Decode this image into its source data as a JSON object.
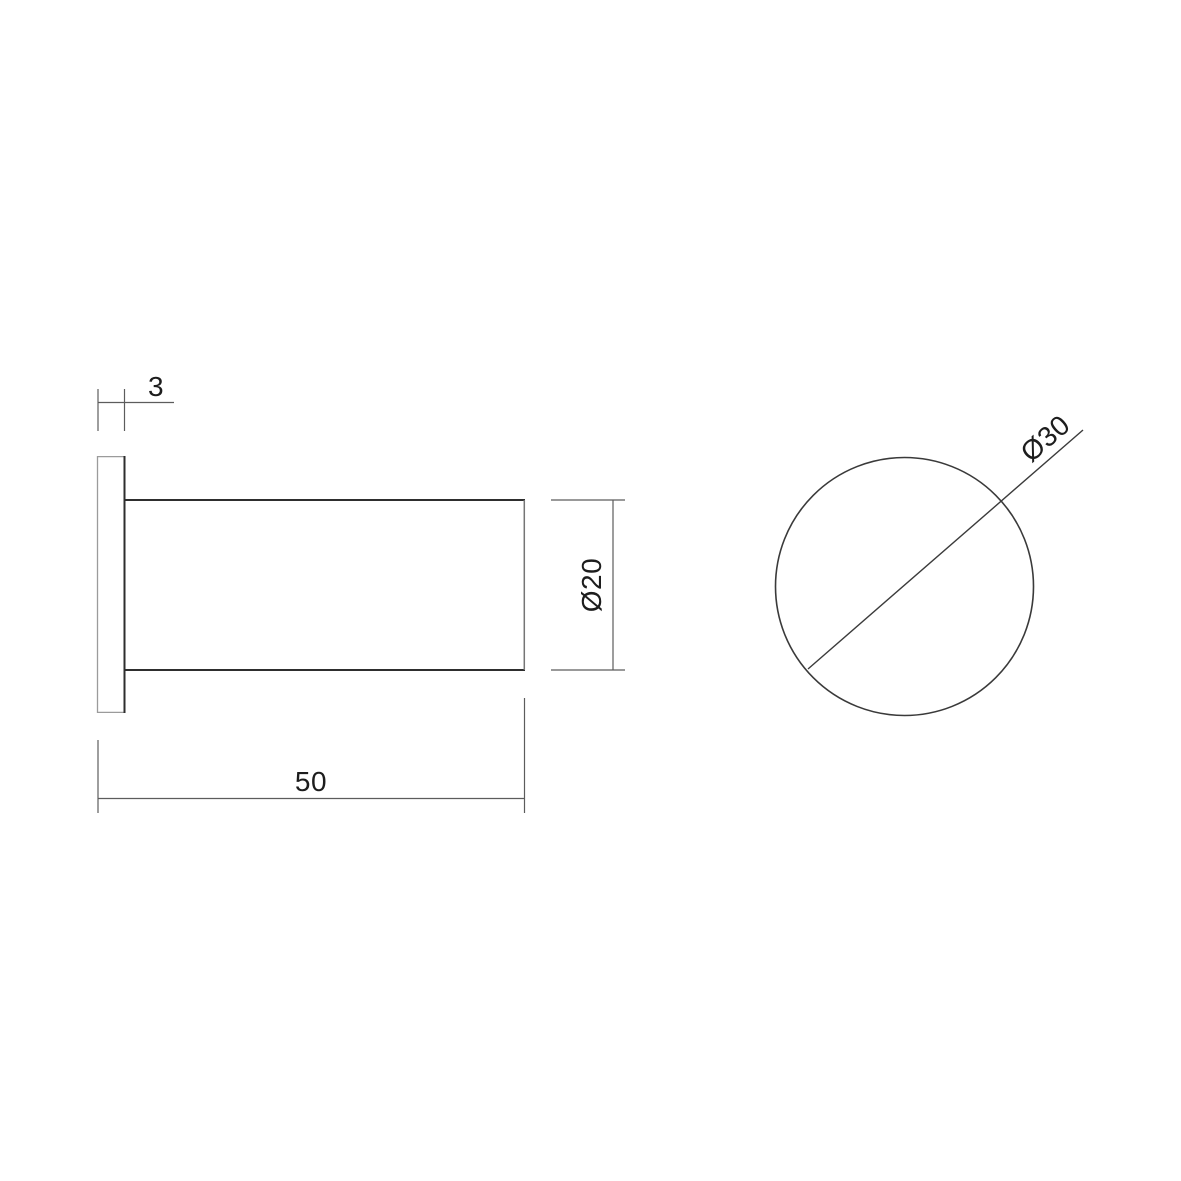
{
  "drawing": {
    "canvas": {
      "width": 1181,
      "height": 1181,
      "background": "#ffffff"
    },
    "styles": {
      "object": {
        "color": "#2e2e2e",
        "width": 2
      },
      "thin": {
        "color": "#9b9b9b",
        "width": 1.3
      },
      "silhouette": {
        "color": "#757575",
        "width": 1.5
      },
      "dimension": {
        "color": "#5c5c5c",
        "width": 1.2
      },
      "circle": {
        "color": "#3a3a3a",
        "width": 1.6
      },
      "diameter": {
        "color": "#3b3b3b",
        "width": 1.4
      },
      "text_color": "#1d1d1d",
      "font_size": 28
    },
    "views": [
      {
        "id": "side-view",
        "shapes": [
          {
            "type": "line",
            "name": "flange-left-edge",
            "style": "thin",
            "x1": 97.5,
            "y1": 456,
            "x2": 97.5,
            "y2": 713
          },
          {
            "type": "line",
            "name": "flange-top-edge",
            "style": "thin",
            "x1": 97.5,
            "y1": 456.6,
            "x2": 124.5,
            "y2": 456.6
          },
          {
            "type": "line",
            "name": "flange-bottom-edge",
            "style": "thin",
            "x1": 97.5,
            "y1": 712.4,
            "x2": 124.5,
            "y2": 712.4
          },
          {
            "type": "line",
            "name": "flange-right-edge",
            "style": "object",
            "x1": 124.5,
            "y1": 456,
            "x2": 124.5,
            "y2": 713
          },
          {
            "type": "line",
            "name": "cylinder-top-edge",
            "style": "object",
            "x1": 124.5,
            "y1": 500,
            "x2": 525,
            "y2": 500
          },
          {
            "type": "line",
            "name": "cylinder-bottom-edge",
            "style": "object",
            "x1": 124.5,
            "y1": 670,
            "x2": 525,
            "y2": 670
          },
          {
            "type": "line",
            "name": "cylinder-end-edge",
            "style": "silhouette",
            "x1": 524.3,
            "y1": 500,
            "x2": 524.3,
            "y2": 670
          }
        ]
      },
      {
        "id": "front-view",
        "shapes": [
          {
            "type": "circle",
            "name": "front-circle",
            "style": "circle",
            "cx": 904.5,
            "cy": 586.5,
            "r": 129
          }
        ]
      }
    ],
    "dimensions": [
      {
        "id": "flange-thickness",
        "label": "3",
        "lines": [
          {
            "x1": 98,
            "y1": 389,
            "x2": 98,
            "y2": 431
          },
          {
            "x1": 124.5,
            "y1": 389,
            "x2": 124.5,
            "y2": 431
          },
          {
            "x1": 98,
            "y1": 402.5,
            "x2": 174,
            "y2": 402.5
          }
        ],
        "text": {
          "x": 156,
          "y": 396,
          "rotate": 0
        }
      },
      {
        "id": "cylinder-diameter",
        "label": "Ø20",
        "lines": [
          {
            "x1": 551,
            "y1": 500,
            "x2": 625,
            "y2": 500
          },
          {
            "x1": 551,
            "y1": 670,
            "x2": 625,
            "y2": 670
          },
          {
            "x1": 613,
            "y1": 500,
            "x2": 613,
            "y2": 670
          }
        ],
        "text": {
          "x": 601,
          "y": 585,
          "rotate": -90
        }
      },
      {
        "id": "cylinder-length",
        "label": "50",
        "lines": [
          {
            "x1": 98,
            "y1": 740,
            "x2": 98,
            "y2": 813
          },
          {
            "x1": 524.5,
            "y1": 698,
            "x2": 524.5,
            "y2": 813
          },
          {
            "x1": 98,
            "y1": 798.5,
            "x2": 525,
            "y2": 798.5
          }
        ],
        "text": {
          "x": 311,
          "y": 791,
          "rotate": 0
        }
      },
      {
        "id": "front-diameter",
        "label": "Ø30",
        "style": "diameter",
        "lines": [
          {
            "x1": 808,
            "y1": 669,
            "x2": 1083,
            "y2": 430
          }
        ],
        "text": {
          "x": 1051.5,
          "y": 445.5,
          "rotate": -41
        }
      }
    ]
  }
}
